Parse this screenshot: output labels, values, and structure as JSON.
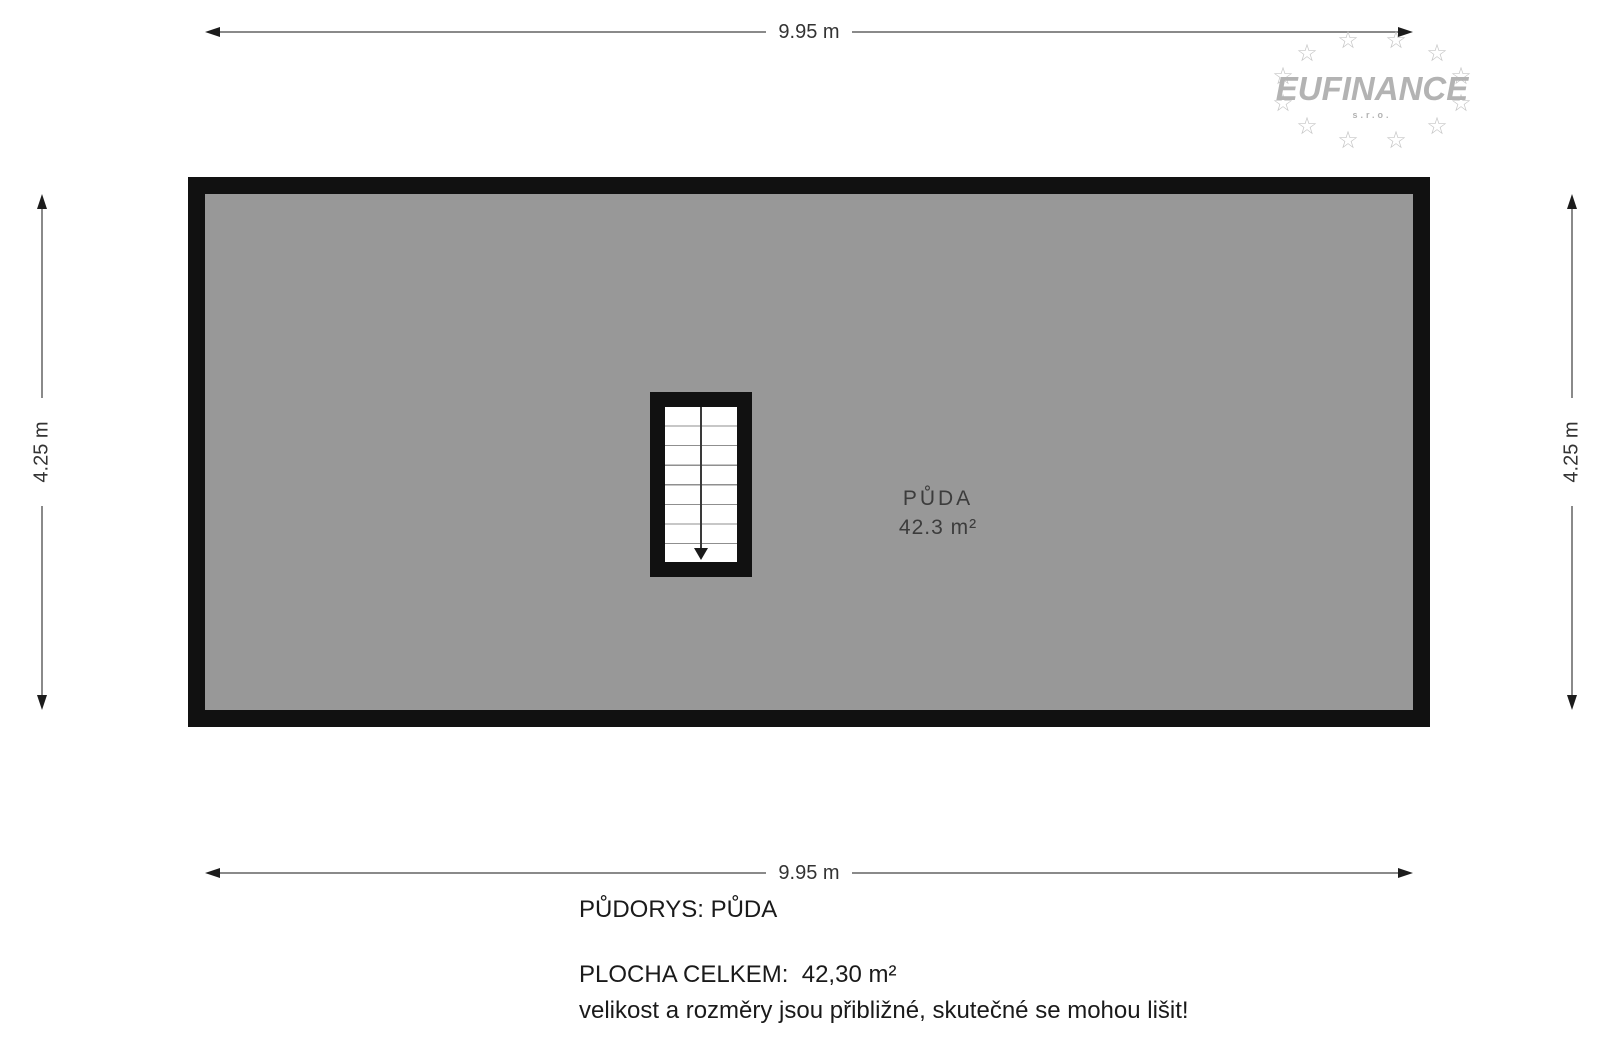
{
  "logo": {
    "name": "EUFINANCE",
    "suffix": "s.r.o.",
    "star_glyph": "☆",
    "color": "#b3b3b3"
  },
  "dimensions": {
    "top": "9.95 m",
    "bottom": "9.95 m",
    "left": "4.25 m",
    "right": "4.25 m"
  },
  "room": {
    "name": "PŮDA",
    "area": "42.3 m²",
    "fill_color": "#989898",
    "wall_color": "#111111"
  },
  "footer": {
    "title": "PŮDORYS: PŮDA",
    "total_area": "PLOCHA CELKEM:  42,30 m²",
    "disclaimer": "velikost a rozměry jsou přibližné, skutečné se mohou lišit!"
  }
}
